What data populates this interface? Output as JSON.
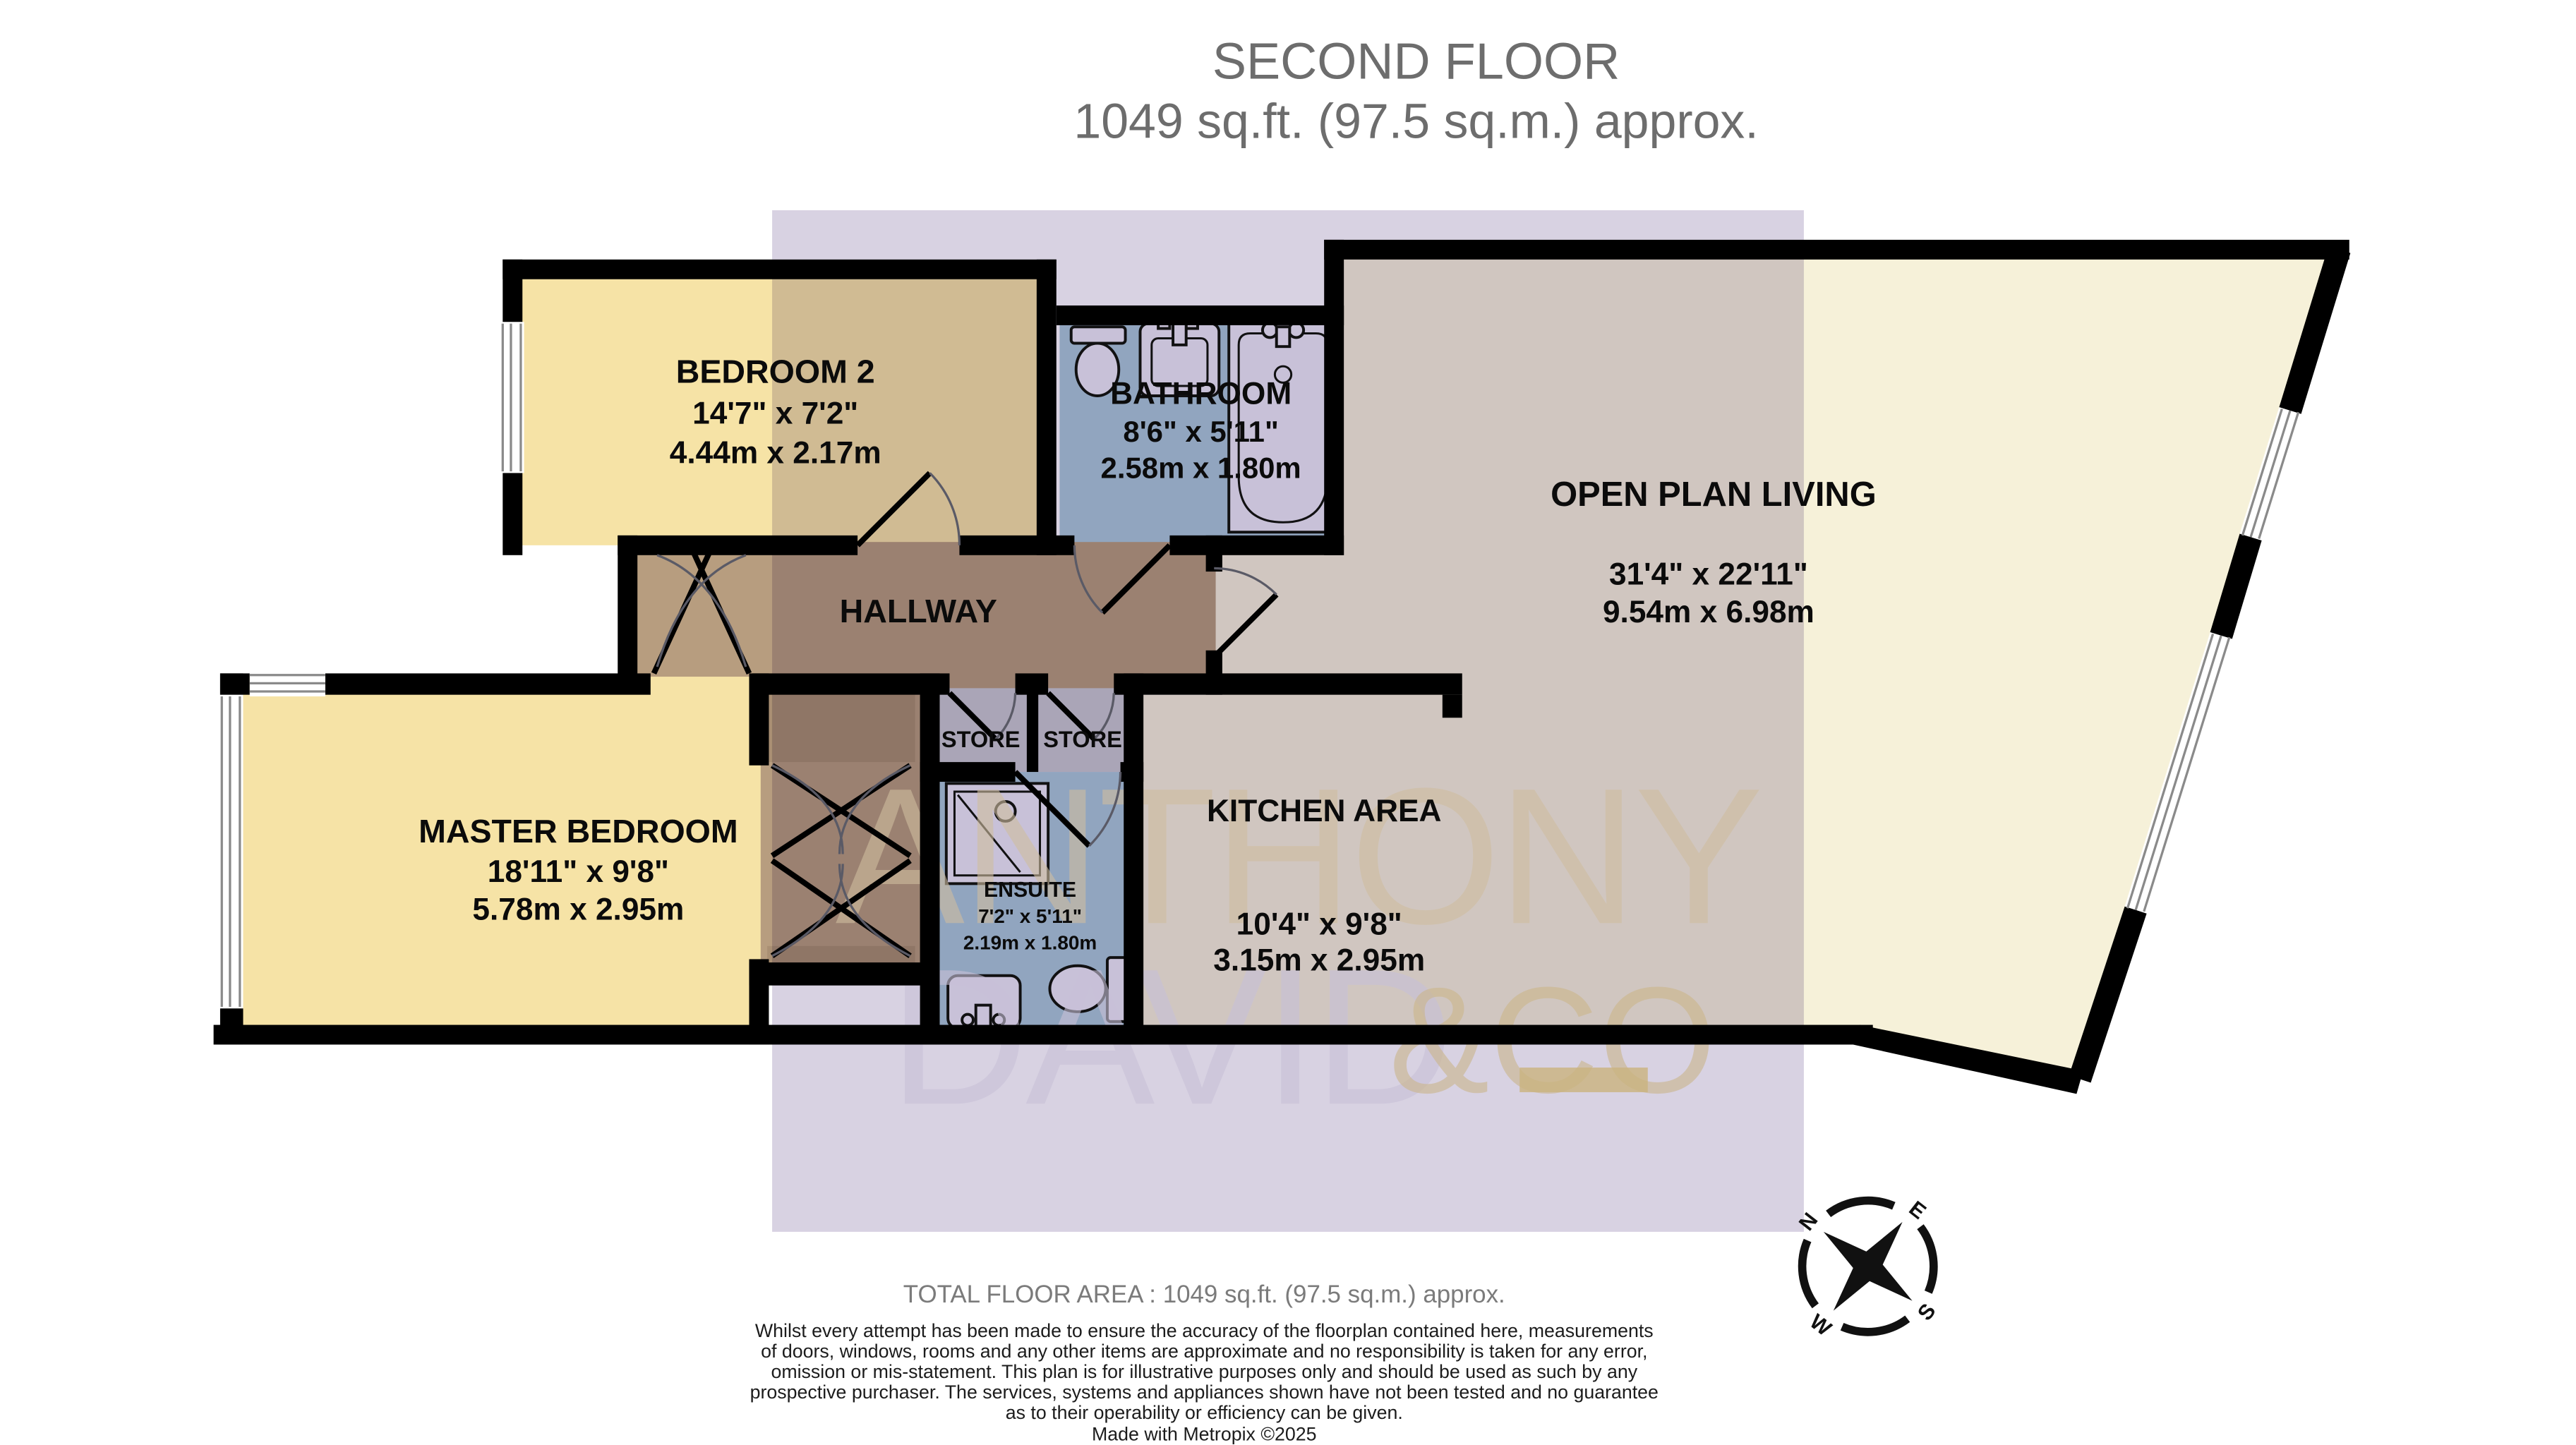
{
  "title": {
    "line1": "SECOND FLOOR",
    "line2": "1049 sq.ft. (97.5 sq.m.) approx."
  },
  "rooms": {
    "bedroom2": {
      "name": "BEDROOM 2",
      "imperial": "14'7\"  x 7'2\"",
      "metric": "4.44m  x 2.17m"
    },
    "bathroom": {
      "name": "BATHROOM",
      "imperial": "8'6\"  x 5'11\"",
      "metric": "2.58m  x 1.80m"
    },
    "open_plan_living": {
      "name": "OPEN PLAN LIVING",
      "imperial": "31'4\"  x 22'11\"",
      "metric": "9.54m  x 6.98m"
    },
    "hallway": {
      "name": "HALLWAY"
    },
    "master_bedroom": {
      "name": "MASTER BEDROOM",
      "imperial": "18'11\"  x 9'8\"",
      "metric": "5.78m  x 2.95m"
    },
    "ensuite": {
      "name": "ENSUITE",
      "imperial": "7'2\"  x 5'11\"",
      "metric": "2.19m  x 1.80m"
    },
    "kitchen": {
      "name": "KITCHEN AREA",
      "imperial": "10'4\"  x 9'8\"",
      "metric": "3.15m  x 2.95m"
    },
    "store1": {
      "name": "STORE"
    },
    "store2": {
      "name": "STORE"
    }
  },
  "compass": {
    "n": "N",
    "e": "E",
    "s": "S",
    "w": "W"
  },
  "watermark": {
    "word1": "ANTHONY",
    "word2": "DAVID",
    "word3": "&CO"
  },
  "footer": {
    "total_area": "TOTAL FLOOR AREA : 1049 sq.ft. (97.5 sq.m.) approx.",
    "disclaimer_lines": [
      "Whilst every attempt has been made to ensure the accuracy of the floorplan contained here, measurements",
      "of doors, windows, rooms and any other items are approximate and no responsibility is taken for any error,",
      "omission or mis-statement. This plan is for illustrative purposes only and should be used as such by any",
      "prospective purchaser. The services, systems and appliances shown have not been tested and no guarantee",
      "as to their operability or efficiency can be given."
    ],
    "credit": "Made with Metropix ©2025"
  },
  "palette": {
    "wall": "#000000",
    "bedroom_yellow": "#F6E3A6",
    "wet_room_blue": "#ABC8D8",
    "hallway_tan": "#B79D7F",
    "wardrobe_brown": "#A98F73",
    "store_gray": "#C9C8CF",
    "living_cream": "#F6F1D9",
    "watermark_veil": "#D8D2E2",
    "watermark_yellow": "#F5E7B4",
    "fixture_fill": "#EDEBF4",
    "title_gray": "#6D6D6D",
    "footer_gray": "#7B7B7B"
  }
}
